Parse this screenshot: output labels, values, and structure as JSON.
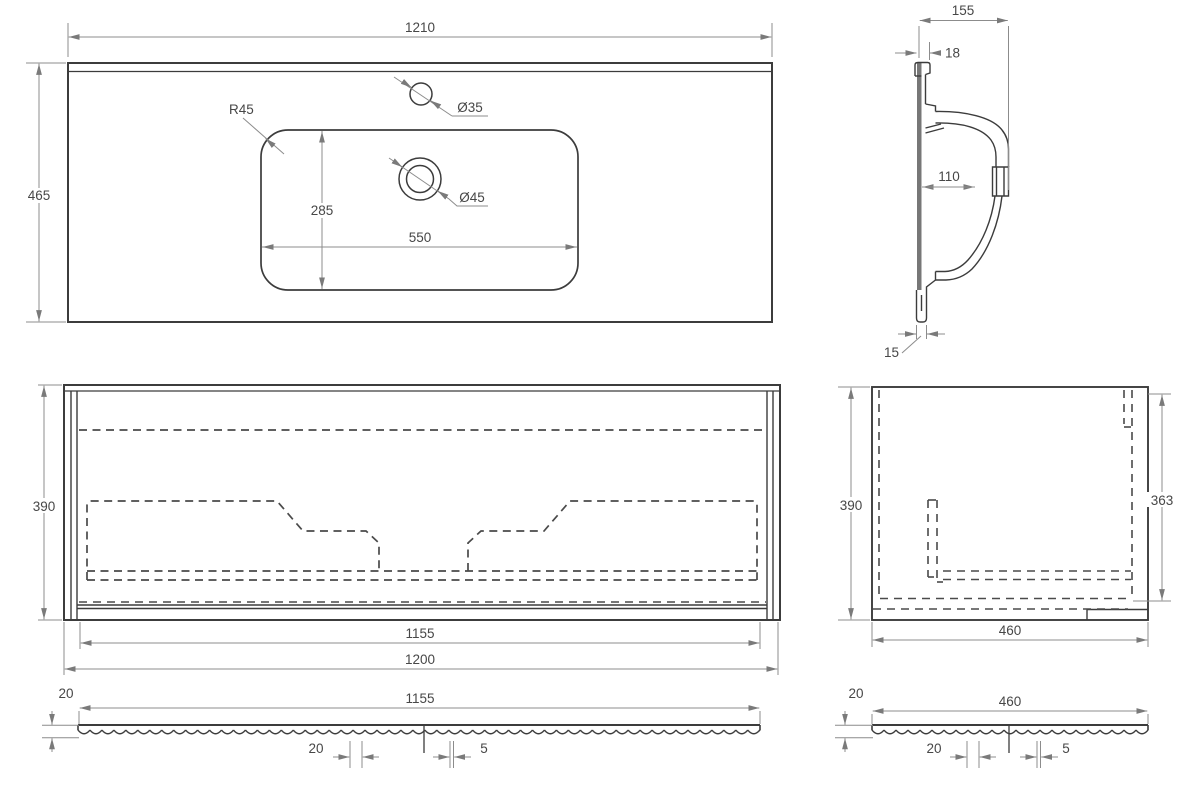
{
  "views": {
    "countertop_top_view": {
      "width": "1210",
      "depth": "465",
      "corner_radius": "R45",
      "faucet_hole_diameter": "Ø35",
      "drain_hole_diameter": "Ø45",
      "basin_cutout_depth": "285",
      "basin_cutout_width": "550"
    },
    "basin_side_section": {
      "total_depth": "155",
      "rim_thickness": "18",
      "inner_depth": "110",
      "bottom_lip": "15"
    },
    "cabinet_front_view": {
      "height": "390",
      "drawer_front_width": "1155",
      "total_width": "1200"
    },
    "cabinet_side_view": {
      "height": "390",
      "inner_height": "363",
      "depth": "460"
    },
    "drawer_front_section": {
      "thickness": "20",
      "width": "1155",
      "flute_pitch": "20",
      "flute_gap": "5"
    },
    "side_panel_section": {
      "thickness": "20",
      "width": "460",
      "flute_pitch": "20",
      "flute_gap": "5"
    }
  }
}
